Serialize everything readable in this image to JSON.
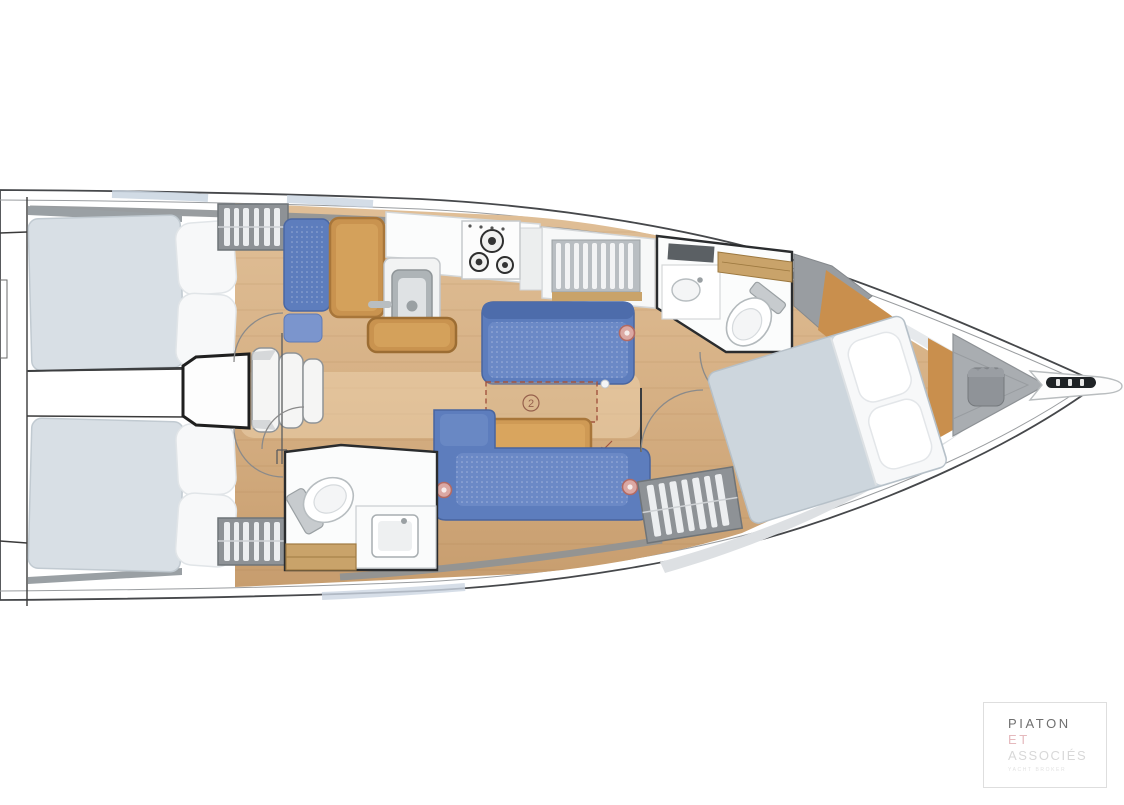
{
  "plan": {
    "table_marker": "2",
    "colors": {
      "hull_line": "#3f4144",
      "deck_shadow": "#e2e5e8",
      "gunwale_gray": "#8e9296",
      "deck_window_tint": "#c9d5e1",
      "floor_wood": "#dcba92",
      "floor_wood_dark": "#c79d6e",
      "aft_mattress": "#d8dfe5",
      "forward_mattress": "#cdd6dd",
      "pillow_white": "#f7f8f9",
      "upholstery_blue": "#5d7dbd",
      "upholstery_blue_dark": "#4c68a6",
      "wood_furniture": "#c9934f",
      "counter_white": "#fbfcfc",
      "appliance_gray": "#aeb4b7",
      "wardrobe_gray": "#8e9296",
      "marker_fill": "#dba8a3",
      "marker_ring": "#b26a63",
      "table_extension_outline": "#a2543f"
    }
  },
  "logo": {
    "line1": "PIATON",
    "line2": "ET",
    "line3": "ASSOCIÉS",
    "subtitle": "YACHT BROKER"
  }
}
